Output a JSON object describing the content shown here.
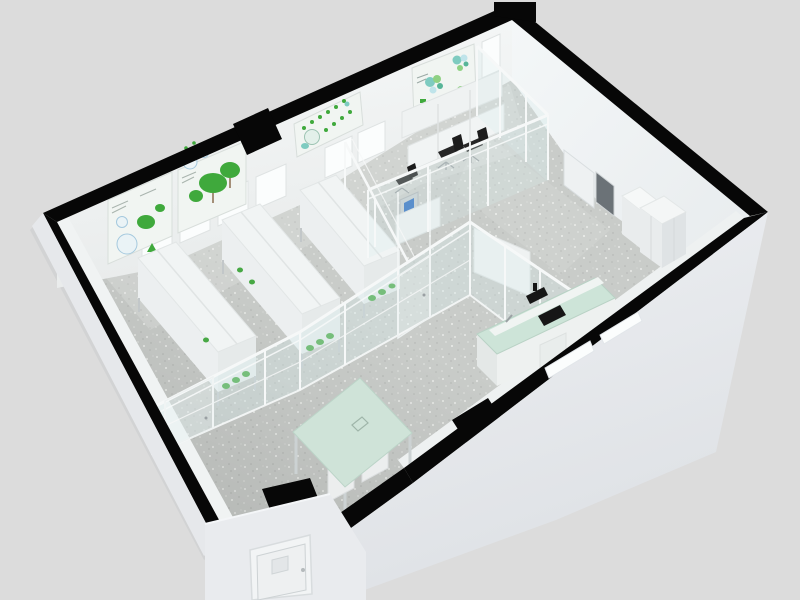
{
  "scene": {
    "description": "3D isometric cutaway render of a laboratory floor plan",
    "rooms": [
      "plant-growth-room",
      "instrument-office",
      "corner-office",
      "open-lab-area",
      "entrance-vestibule"
    ]
  },
  "colors": {
    "background": "#dcdcdc",
    "wall_cut_black": "#070707",
    "exterior_strip": "#e6e8eb",
    "exterior_vestibule": "#e9ebee",
    "interior_wall": "#f5f7f7",
    "floor_base": "#c9ccc9",
    "window_white": "#fbfdfd",
    "glass_tint": "#d8ecec",
    "glass_frame": "#f6f8f8",
    "poster_bg": "#f1f5f2",
    "poster_green": "#3fa93c",
    "poster_teal": "#7ecbc0",
    "plant_green": "#47a844",
    "bench_top_green": "#cde4d8",
    "table_top_green": "#cfe3d8",
    "furniture_white": "#f1f4f4",
    "furniture_shade": "#e6eaea",
    "equipment_black": "#161616",
    "door_gray": "#6b7277",
    "chair_black": "#262626",
    "metal_gray": "#9aa0a3",
    "monitor_blue": "#2f6fc2",
    "column_inner": "#e8e9eb"
  },
  "inventory": {
    "grow_racks": 3,
    "office_chairs": 3,
    "desk_carrels": 1,
    "green_top_lab_bench": 1,
    "green_top_table": 1,
    "storage_cabinets": 2,
    "wall_posters": 4,
    "back_wall_windows": 7,
    "doors": 4,
    "wall_columns": 2
  }
}
